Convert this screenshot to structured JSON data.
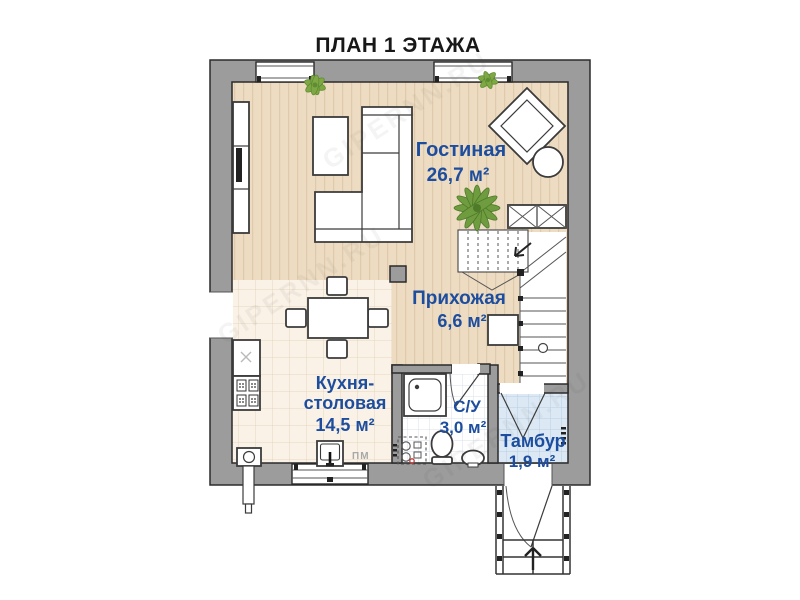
{
  "title": "ПЛАН 1 ЭТАЖА",
  "watermark": "GIPERNN.RU",
  "rooms": [
    {
      "id": "living",
      "name": "Гостиная",
      "area": "26,7 м²"
    },
    {
      "id": "hall",
      "name": "Прихожая",
      "area": "6,6 м²"
    },
    {
      "id": "kitchen",
      "name": "Кухня-столовая",
      "name_line1": "Кухня-",
      "name_line2": "столовая",
      "area": "14,5 м²"
    },
    {
      "id": "bathroom",
      "name": "С/У",
      "area": "3,0 м²"
    },
    {
      "id": "vestibule",
      "name": "Тамбур",
      "area": "1,9 м²"
    }
  ],
  "labels": {
    "dishwasher": "ПМ"
  },
  "colors": {
    "wall": "#9c9c9c",
    "wall_outline": "#2b2b2b",
    "label_blue": "#1d4d9e",
    "wood_floor": "#eddcc2",
    "kitchen_tile": "#faf2e6",
    "bath_tile": "#ffffff",
    "vestibule_tile": "#dce9f4",
    "plant_green": "#6f9c3f",
    "drain_red": "#c23b3b"
  }
}
